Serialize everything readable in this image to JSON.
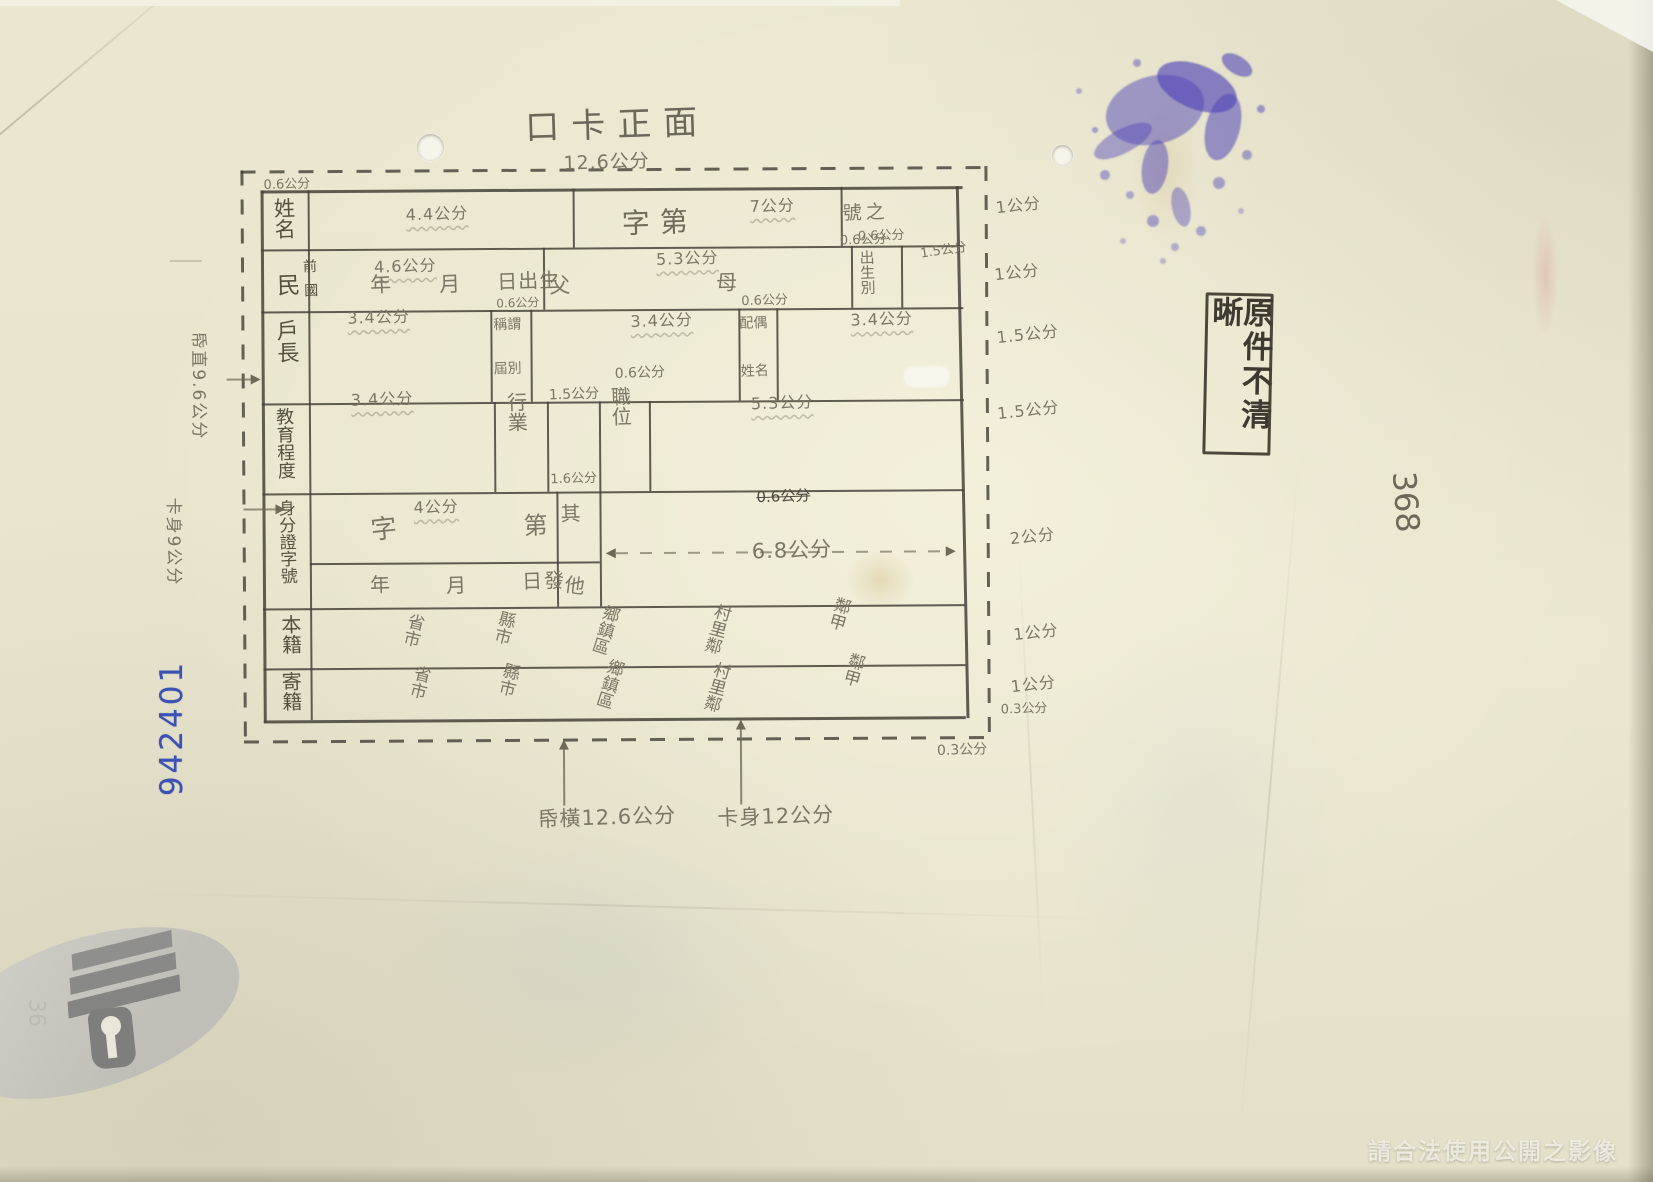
{
  "artifact": {
    "title": "口卡正面",
    "watermark": "請合法使用公開之影像",
    "stamp": "原件不清晰",
    "blue_serial": "942401",
    "side_number": "368",
    "margin_mark": "36"
  },
  "dims": {
    "top_width": "12.6公分",
    "corner_gap": "0.6公分",
    "left_paper_height": "帋直9.6公分",
    "left_card_height": "卡身9公分",
    "bottom_paper_width": "帋橫12.6公分",
    "bottom_card_width": "卡身12公分",
    "bottom_gap_upper": "0.3公分",
    "bottom_gap_lower": "0.3公分",
    "right": {
      "r1": "1公分",
      "r2": "1公分",
      "r3": "1.5公分",
      "r4": "1.5公分",
      "r56": "2公分",
      "r7": "1公分",
      "r8": "1公分",
      "col_birth": "1.5公分"
    }
  },
  "rows": {
    "r1": {
      "label": "姓名",
      "cell_dim": "4.4公分",
      "serial_prefix": "字第",
      "cell2_dim": "7公分",
      "serial_suffix": "號之",
      "sub_dim": "0.6公分"
    },
    "r2": {
      "label": "民",
      "label_sub_top": "前",
      "label_sub_bottom": "國",
      "cell_dim": "4.6公分",
      "year": "年",
      "month": "月",
      "day": "日出生",
      "father": "父",
      "cell2_dim": "5.3公分",
      "mother": "母",
      "col_dim": "0.6公分",
      "col_label": "出生別"
    },
    "r3": {
      "label": "戶長",
      "cell1_dim": "3.4公分",
      "col1_dim": "0.6公分",
      "col1_top": "稱謂",
      "col1_bottom": "屆別",
      "cell2_dim": "3.4公分",
      "col2_dim": "0.6公分",
      "col2_top": "配偶",
      "col2_bottom": "姓名",
      "cell3_dim": "3.4公分"
    },
    "r4": {
      "label": "教育程度",
      "cell1_dim": "3.4公分",
      "col1": "行業",
      "cell2_dim": "1.5公分",
      "col2_dim": "0.6公分",
      "col2": "職位",
      "cell3_dim": "5.3公分"
    },
    "r56": {
      "label": "身分證字號",
      "cell_dim": "4公分",
      "prefix": "字",
      "suffix": "第",
      "col_dim": "1.6公分",
      "col_top": "其",
      "col_bottom": "他",
      "struck_dim": "0.6公分",
      "span_dim": "6.8公分",
      "year": "年",
      "month": "月",
      "day_issued": "日發"
    },
    "r7": {
      "label": "本籍",
      "items": [
        "省市",
        "縣市",
        "鄉鎮區",
        "村里鄰",
        "鄰甲"
      ]
    },
    "r8": {
      "label": "寄籍",
      "items": [
        "省市",
        "縣市",
        "鄉鎮區",
        "村里鄰",
        "鄰甲"
      ]
    }
  }
}
